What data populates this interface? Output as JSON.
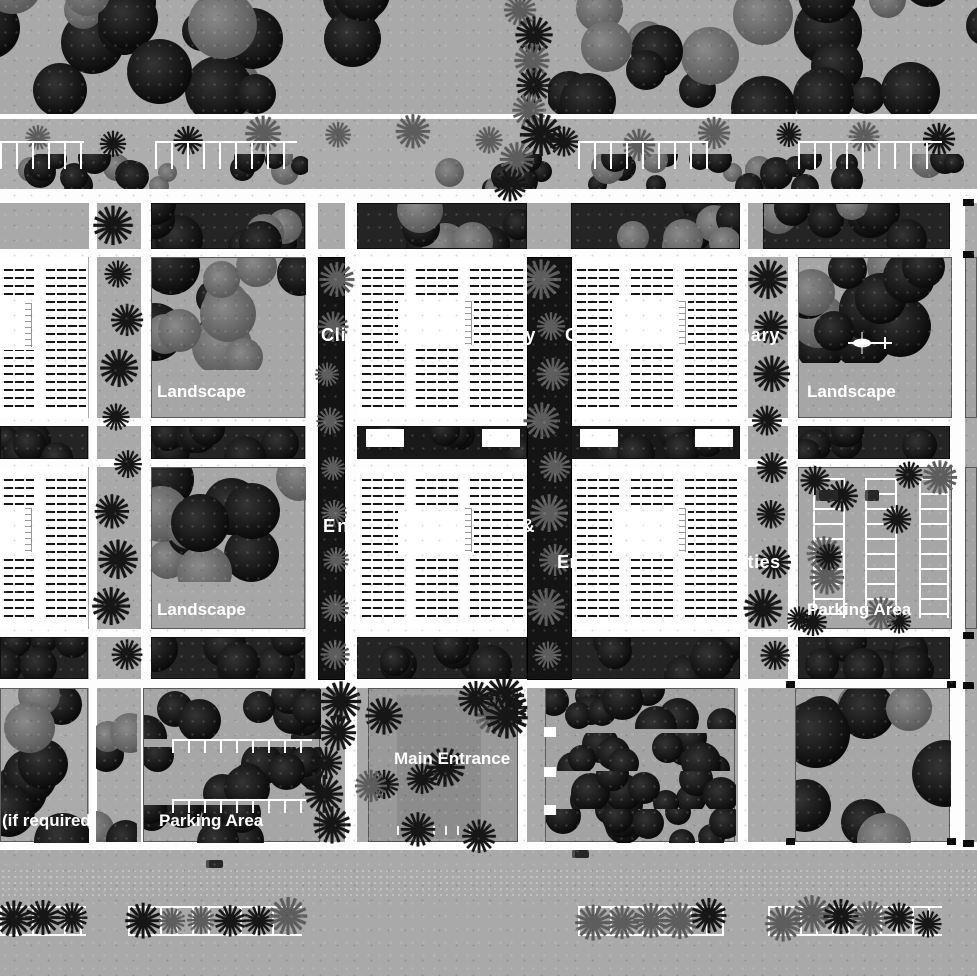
{
  "plan": {
    "kind": "hospital campus site plan (black & white)",
    "labels": {
      "clinic_left": "Clinic Multidisciplinary",
      "clinic_right": "Clinic Multidisciplinary",
      "entrance_building": "Entrance Building &",
      "emergency_specialties": "Emergency & specialties",
      "landscape_nw": "Landscape",
      "landscape_ne": "Landscape",
      "landscape_w": "Landscape",
      "parking_e": "Parking Area",
      "parking_sw": "Parking Area",
      "main_entrance": "Main Entrance",
      "expansion_note": "(if required"
    },
    "icons": {
      "helipad": "helicopter-icon",
      "palm_tree": "palm-tree-icon",
      "round_tree": "tree-icon",
      "car": "car-icon"
    },
    "colors": {
      "ground": "#a9a9a9",
      "road": "#fdfdfd",
      "tree_dark": "#0a0a0a",
      "tree_gray": "#565656",
      "palm_gray": "#5d5d5d",
      "building": "#ffffff",
      "hatch_line": "#161616",
      "label_text": "#ffffff"
    }
  }
}
